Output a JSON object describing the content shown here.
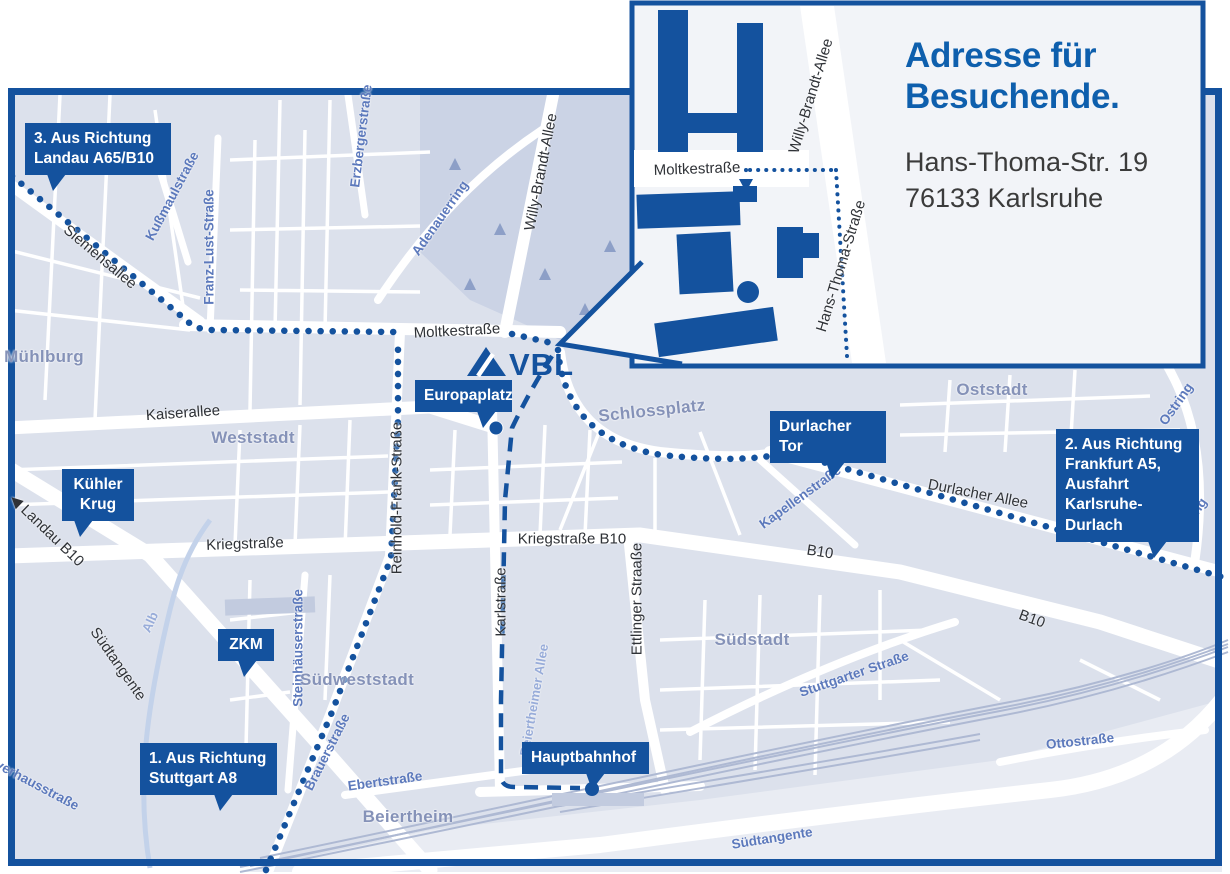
{
  "brand": {
    "primary": "#14529E",
    "title_blue": "#0E5FAD",
    "map_bg": "#DCE1EC",
    "open_area": "#E9ECF3",
    "park": "#CBD3E5",
    "street_white": "#FFFFFF",
    "area_label": "#8592B8",
    "street_blue_label": "#5C79BC",
    "street_lightblue_label": "#98ACD9",
    "street_dark_label": "#2F3237",
    "address_text": "#3B3B3B"
  },
  "logo": {
    "text": "VBL"
  },
  "callout": {
    "title": "Adresse für\nBesuchende.",
    "address": "Hans-Thoma-Str. 19\n76133 Karlsruhe"
  },
  "map": {
    "labels": [
      {
        "t": "Siemensallee",
        "x": 100,
        "y": 257,
        "r": 40,
        "c": "dark"
      },
      {
        "t": "Moltkestraße",
        "x": 457,
        "y": 331,
        "r": -3,
        "c": "dark"
      },
      {
        "t": "Kaiserallee",
        "x": 183,
        "y": 413,
        "r": -4,
        "c": "dark"
      },
      {
        "t": "Kriegstraße",
        "x": 245,
        "y": 544,
        "r": -2,
        "c": "dark"
      },
      {
        "t": "Kriegstraße B10",
        "x": 572,
        "y": 539,
        "r": 0,
        "c": "dark"
      },
      {
        "t": "B10",
        "x": 820,
        "y": 552,
        "r": 9,
        "c": "dark"
      },
      {
        "t": "B10",
        "x": 1032,
        "y": 619,
        "r": 20,
        "c": "dark"
      },
      {
        "t": "◀ Landau B10",
        "x": 47,
        "y": 530,
        "r": 44,
        "c": "dark"
      },
      {
        "t": "Karlstraße",
        "x": 501,
        "y": 602,
        "r": -90,
        "c": "dark"
      },
      {
        "t": "Ettlinger Straaße",
        "x": 637,
        "y": 599,
        "r": -90,
        "c": "dark"
      },
      {
        "t": "Reinhold-Frank-Straße",
        "x": 397,
        "y": 498,
        "r": -90,
        "c": "dark"
      },
      {
        "t": "Willy-Brandt-Allee",
        "x": 541,
        "y": 172,
        "r": -79,
        "c": "dark"
      },
      {
        "t": "Durlacher Allee",
        "x": 978,
        "y": 494,
        "r": 11,
        "c": "dark"
      },
      {
        "t": "Südtangente",
        "x": 118,
        "y": 664,
        "r": 55,
        "c": "dark"
      },
      {
        "t": "Moltkestraße",
        "x": 697,
        "y": 169,
        "r": -2,
        "c": "dark"
      },
      {
        "t": "Willy-Brandt-Allee",
        "x": 811,
        "y": 96,
        "r": -73,
        "c": "dark"
      },
      {
        "t": "Hans-Thoma-Straße",
        "x": 841,
        "y": 266,
        "r": -73,
        "c": "dark"
      },
      {
        "t": "Kußmaulstraße",
        "x": 172,
        "y": 196,
        "r": -62,
        "c": "blue"
      },
      {
        "t": "Franz-Lust-Straße",
        "x": 209,
        "y": 247,
        "r": -90,
        "c": "blue"
      },
      {
        "t": "Erzbergerstraße",
        "x": 361,
        "y": 136,
        "r": -83,
        "c": "blue"
      },
      {
        "t": "Adenauerring",
        "x": 440,
        "y": 218,
        "r": -55,
        "c": "blue"
      },
      {
        "t": "Kapellenstraße",
        "x": 800,
        "y": 497,
        "r": -36,
        "c": "blue"
      },
      {
        "t": "Ostring",
        "x": 1176,
        "y": 404,
        "r": -55,
        "c": "blue"
      },
      {
        "t": "Ostring",
        "x": 1190,
        "y": 519,
        "r": -55,
        "c": "blue"
      },
      {
        "t": "Steinhäuserstraße",
        "x": 298,
        "y": 648,
        "r": -90,
        "c": "blue"
      },
      {
        "t": "Brauerstraße",
        "x": 327,
        "y": 752,
        "r": -63,
        "c": "blue"
      },
      {
        "t": "Stuttgarter Straße",
        "x": 854,
        "y": 674,
        "r": -19,
        "c": "blue"
      },
      {
        "t": "Ottostraße",
        "x": 1080,
        "y": 741,
        "r": -6,
        "c": "blue"
      },
      {
        "t": "Südtangente",
        "x": 772,
        "y": 838,
        "r": -9,
        "c": "blue"
      },
      {
        "t": "Pulverhausstraße",
        "x": 28,
        "y": 780,
        "r": 28,
        "c": "blue"
      },
      {
        "t": "Ebertstraße",
        "x": 385,
        "y": 781,
        "r": -8,
        "c": "blue"
      },
      {
        "t": "Alb",
        "x": 150,
        "y": 622,
        "r": -65,
        "c": "lightblue"
      },
      {
        "t": "Beiertheimer Allee",
        "x": 534,
        "y": 700,
        "r": -80,
        "c": "lightblue"
      },
      {
        "t": "Mühlburg",
        "x": 44,
        "y": 357,
        "r": 0,
        "c": "area"
      },
      {
        "t": "Weststadt",
        "x": 253,
        "y": 438,
        "r": 0,
        "c": "area"
      },
      {
        "t": "Oststadt",
        "x": 992,
        "y": 390,
        "r": 0,
        "c": "area"
      },
      {
        "t": "Südstadt",
        "x": 752,
        "y": 640,
        "r": 0,
        "c": "area"
      },
      {
        "t": "Südweststadt",
        "x": 357,
        "y": 680,
        "r": 0,
        "c": "area"
      },
      {
        "t": "Beiertheim",
        "x": 408,
        "y": 817,
        "r": 0,
        "c": "area"
      },
      {
        "t": "Schlossplatz",
        "x": 652,
        "y": 411,
        "r": -6,
        "c": "area"
      }
    ],
    "callouts": [
      {
        "n": "route-3-landau",
        "t": "3. Aus Richtung\nLandau A65/B10",
        "x": 25,
        "y": 123,
        "w": 146,
        "p": 22
      },
      {
        "n": "kuehler-krug",
        "t": "Kühler\nKrug",
        "x": 62,
        "y": 469,
        "w": 72,
        "p": 12,
        "center": true
      },
      {
        "n": "zkm",
        "t": "ZKM",
        "x": 218,
        "y": 629,
        "w": 56,
        "p": 20,
        "center": true
      },
      {
        "n": "route-1-stuttgart",
        "t": "1. Aus Richtung\nStuttgart A8",
        "x": 140,
        "y": 743,
        "w": 137,
        "p": 74
      },
      {
        "n": "europaplatz",
        "t": "Europaplatz",
        "x": 415,
        "y": 380,
        "w": 97,
        "p": 62
      },
      {
        "n": "durlacher-tor",
        "t": "Durlacher Tor",
        "x": 770,
        "y": 411,
        "w": 116,
        "p": 56
      },
      {
        "n": "route-2-frankfurt",
        "t": "2. Aus Richtung\nFrankfurt A5,\nAusfahrt\nKarlsruhe-Durlach",
        "x": 1056,
        "y": 429,
        "w": 143,
        "p": 92
      },
      {
        "n": "hauptbahnhof",
        "t": "Hauptbahnhof",
        "x": 522,
        "y": 742,
        "w": 127,
        "p": 64
      }
    ]
  }
}
